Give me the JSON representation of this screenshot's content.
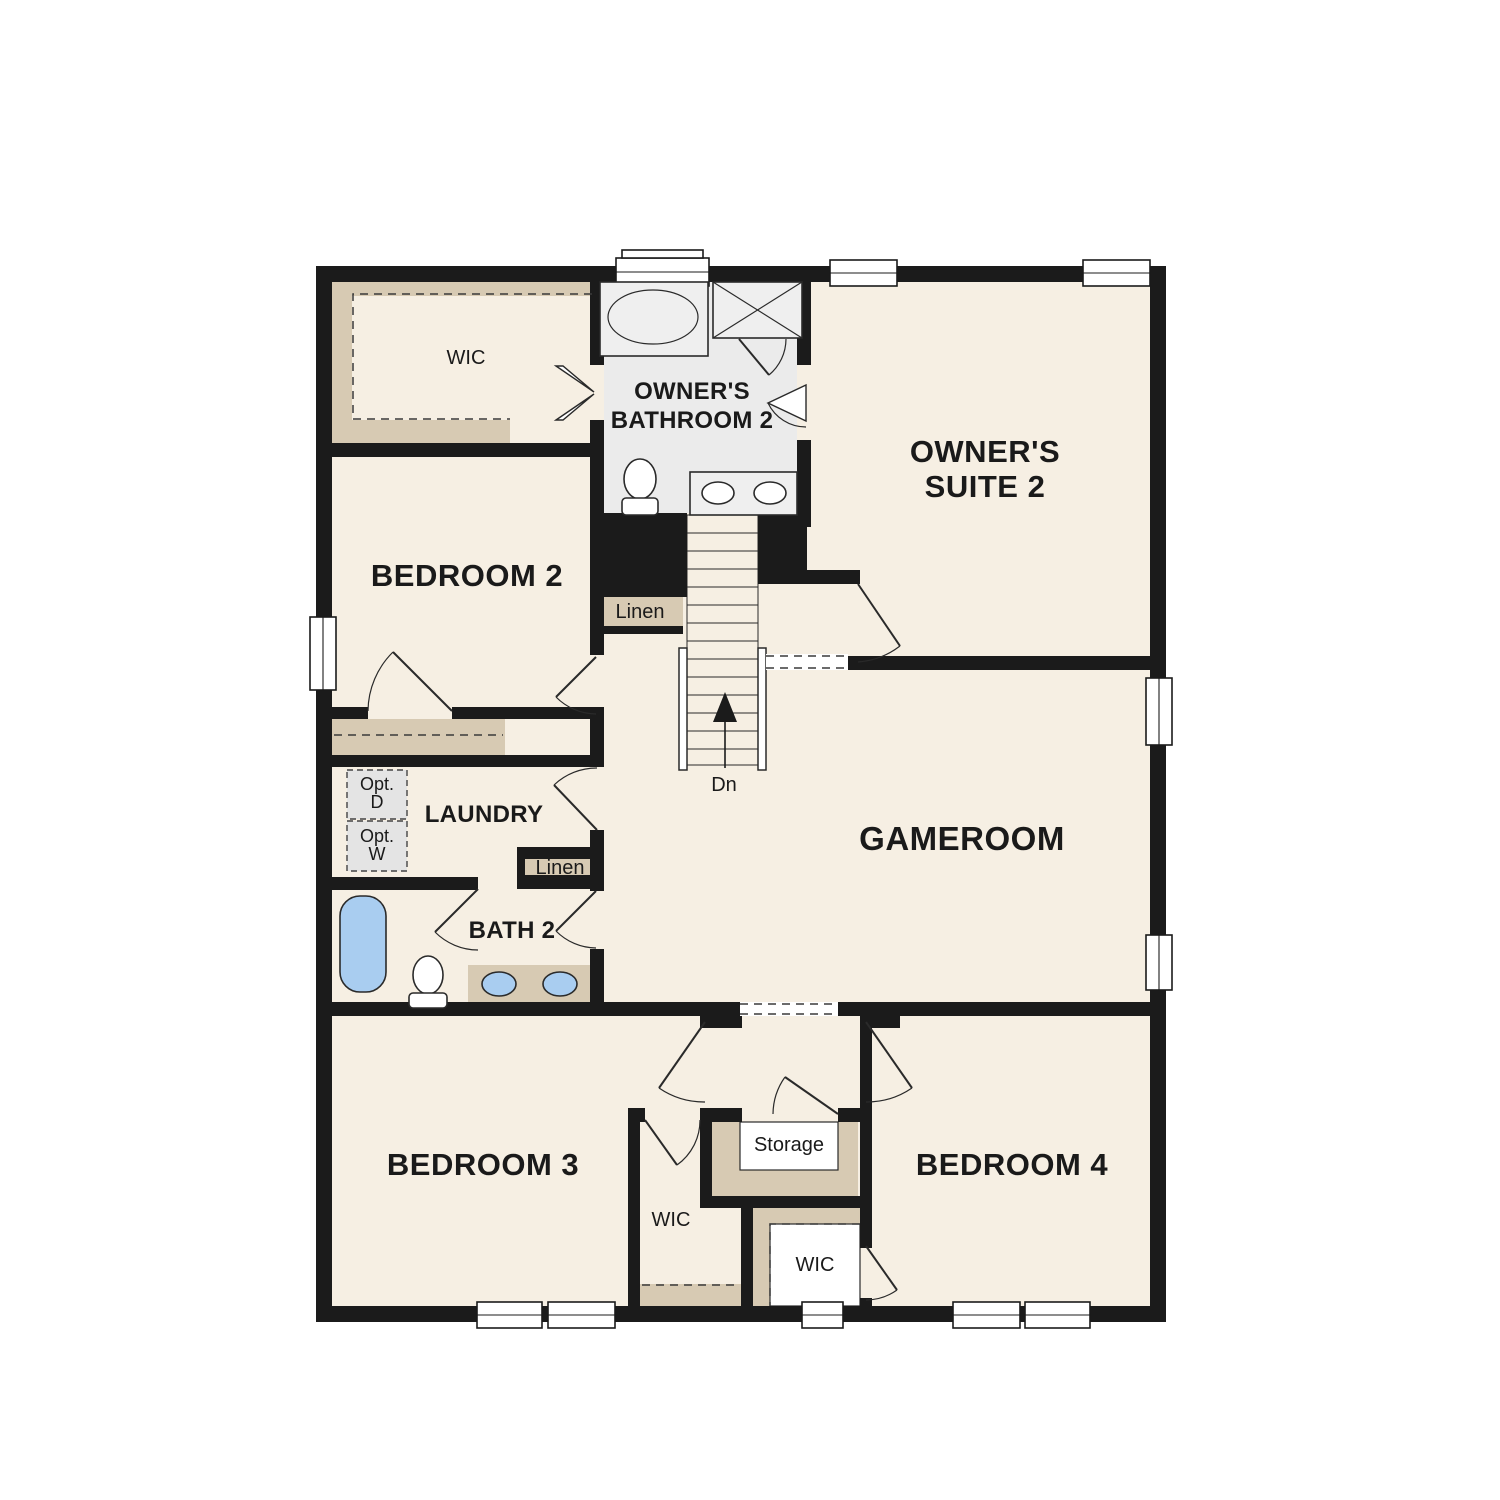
{
  "plan": {
    "labels": {
      "wic_owners": "WIC",
      "owners_bathroom": {
        "line1": "OWNER'S",
        "line2": "BATHROOM 2"
      },
      "owners_suite": {
        "line1": "OWNER'S",
        "line2": "SUITE 2"
      },
      "bedroom2": "BEDROOM 2",
      "linen_stairs": "Linen",
      "stairs_direction": "Dn",
      "laundry": "LAUNDRY",
      "opt_dryer": {
        "line1": "Opt.",
        "line2": "D"
      },
      "opt_washer": {
        "line1": "Opt.",
        "line2": "W"
      },
      "linen_bath": "Linen",
      "bath2": "BATH 2",
      "gameroom": "GAMEROOM",
      "bedroom3": "BEDROOM 3",
      "bedroom4": "BEDROOM 4",
      "storage": "Storage",
      "wic_bedroom3": "WIC",
      "wic_bedroom4": "WIC"
    },
    "palette": {
      "floor": "#f6efe3",
      "shelf": "#d7cab3",
      "wall": "#1b1b1b",
      "bathfloor": "#ebebeb",
      "fixture": "#efefef",
      "blue": "#a9cdf0",
      "graybox": "#e4e4e4"
    }
  }
}
